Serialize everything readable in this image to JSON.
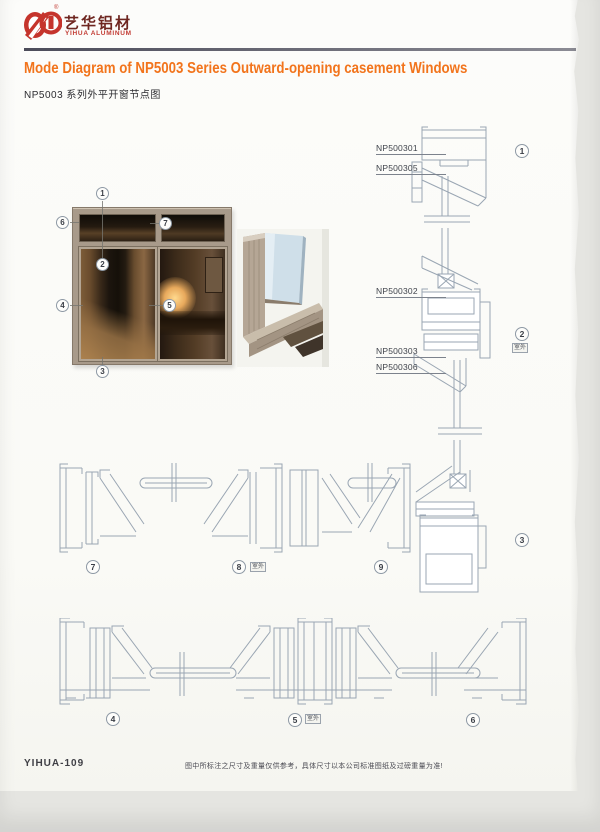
{
  "brand": {
    "name_cn": "艺华铝材",
    "name_en": "YIHUA ALUMINUM",
    "reg": "®"
  },
  "header": {
    "title_en": "Mode Diagram of NP5003 Series Outward-opening casement Windows",
    "title_cn": "NP5003 系列外平开窗节点图"
  },
  "section_labels": {
    "l301": "NP500301",
    "l305": "NP500305",
    "l302": "NP500302",
    "l303": "NP500303",
    "l306": "NP500306"
  },
  "callouts": {
    "n1": "1",
    "n2": "2",
    "n3": "3",
    "n4": "4",
    "n5": "5",
    "n6": "6",
    "n7": "7",
    "n8": "8",
    "n9": "9",
    "outdoor": "室外"
  },
  "footer": {
    "code": "YIHUA-109",
    "disclaimer": "图中所标注之尺寸及重量仅供参考，具体尺寸以本公司标准图纸及过磅重量为准!"
  },
  "colors": {
    "brand_red": "#c5342c",
    "title_orange": "#f2741c",
    "header_rule": "#5b5b66",
    "drawing_line": "#9aa6b3",
    "window_frame_tan": "#a89a8a"
  }
}
